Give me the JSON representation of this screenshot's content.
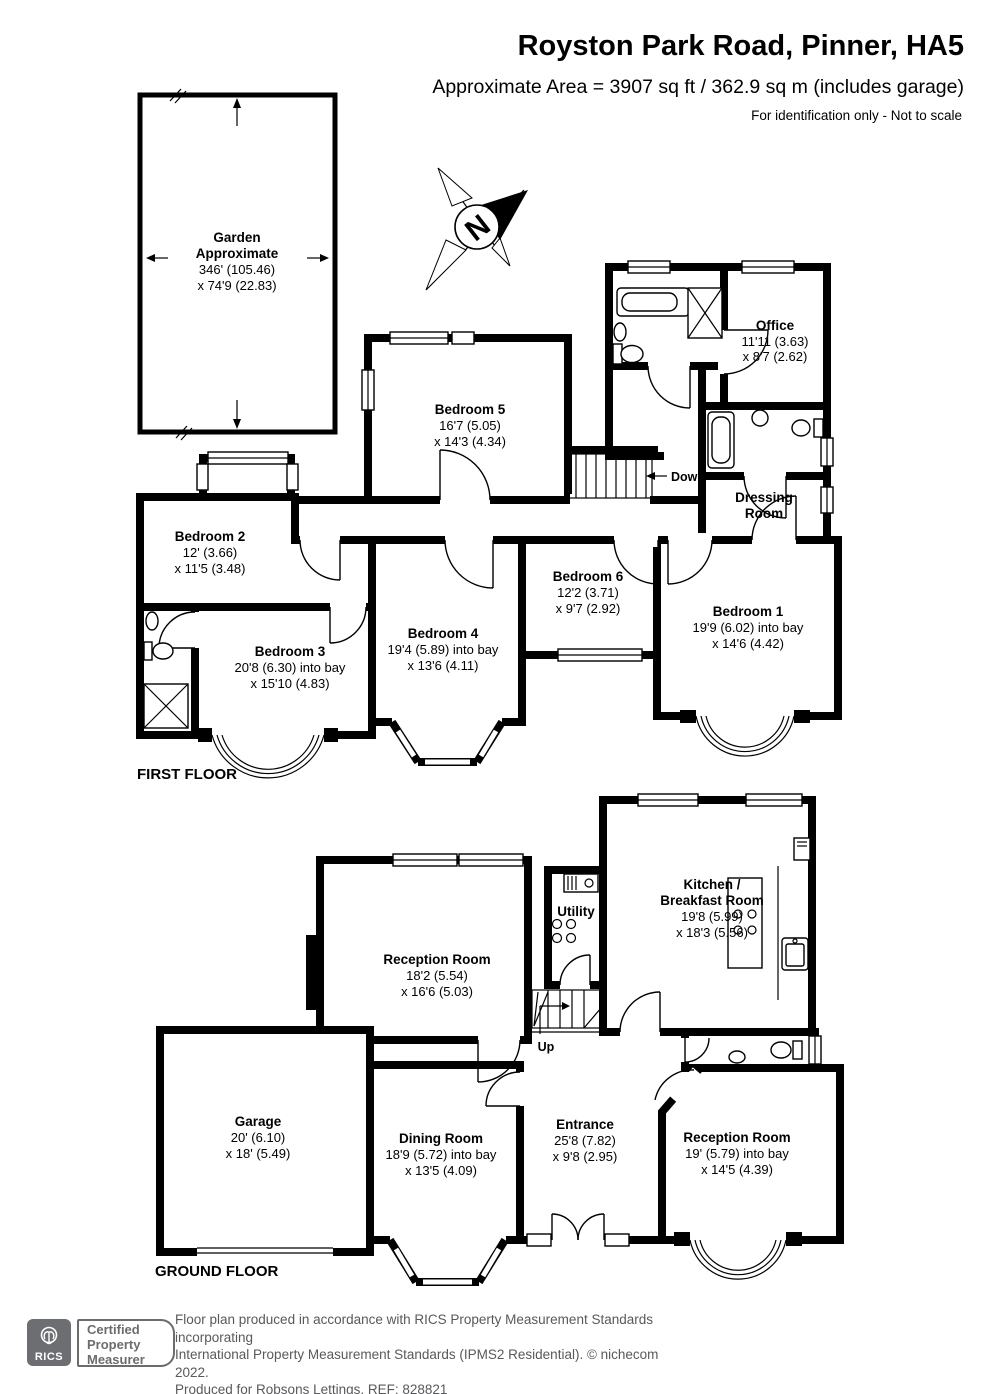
{
  "header": {
    "title": "Royston Park Road, Pinner, HA5",
    "subtitle": "Approximate Area = 3907 sq ft / 362.9 sq m (includes garage)",
    "note": "For identification only - Not to scale"
  },
  "garden": {
    "name": "Garden",
    "line2": "Approximate",
    "dim1": "346' (105.46)",
    "dim2": "x 74'9 (22.83)"
  },
  "compass": {
    "letter": "N"
  },
  "ff": {
    "floor_label": "FIRST FLOOR",
    "stairs_label": "Down",
    "office": {
      "name": "Office",
      "dim1": "11'11 (3.63)",
      "dim2": "x 8'7 (2.62)"
    },
    "bedroom5": {
      "name": "Bedroom 5",
      "dim1": "16'7 (5.05)",
      "dim2": "x 14'3 (4.34)"
    },
    "dressing": {
      "name1": "Dressing",
      "name2": "Room"
    },
    "bedroom2": {
      "name": "Bedroom 2",
      "dim1": "12' (3.66)",
      "dim2": "x 11'5 (3.48)"
    },
    "bedroom3": {
      "name": "Bedroom 3",
      "dim1": "20'8 (6.30) into bay",
      "dim2": "x 15'10 (4.83)"
    },
    "bedroom4": {
      "name": "Bedroom 4",
      "dim1": "19'4 (5.89) into bay",
      "dim2": "x 13'6 (4.11)"
    },
    "bedroom6": {
      "name": "Bedroom 6",
      "dim1": "12'2 (3.71)",
      "dim2": "x 9'7 (2.92)"
    },
    "bedroom1": {
      "name": "Bedroom 1",
      "dim1": "19'9 (6.02) into bay",
      "dim2": "x 14'6 (4.42)"
    }
  },
  "gf": {
    "floor_label": "GROUND FLOOR",
    "stairs_label": "Up",
    "kitchen": {
      "name1": "Kitchen /",
      "name2": "Breakfast Room",
      "dim1": "19'8 (5.99)",
      "dim2": "x 18'3 (5.56)"
    },
    "utility": {
      "name": "Utility"
    },
    "reception_top": {
      "name": "Reception Room",
      "dim1": "18'2 (5.54)",
      "dim2": "x 16'6 (5.03)"
    },
    "garage": {
      "name": "Garage",
      "dim1": "20' (6.10)",
      "dim2": "x 18' (5.49)"
    },
    "dining": {
      "name": "Dining Room",
      "dim1": "18'9 (5.72) into bay",
      "dim2": "x 13'5 (4.09)"
    },
    "entrance": {
      "name": "Entrance",
      "dim1": "25'8 (7.82)",
      "dim2": "x 9'8 (2.95)"
    },
    "reception_bottom": {
      "name": "Reception Room",
      "dim1": "19' (5.79) into bay",
      "dim2": "x 14'5 (4.39)"
    }
  },
  "footer": {
    "rics": "RICS",
    "badge1": "Certified",
    "badge2": "Property",
    "badge3": "Measurer",
    "line1": "Floor plan produced in accordance with RICS Property Measurement Standards incorporating",
    "line2": "International Property Measurement Standards (IPMS2 Residential).  © nichecom 2022.",
    "line3": "Produced for Robsons Lettings.  REF: 828821"
  },
  "colors": {
    "wall": "#000000",
    "footer_text": "#58595b",
    "rics_gray": "#6d6e71"
  }
}
